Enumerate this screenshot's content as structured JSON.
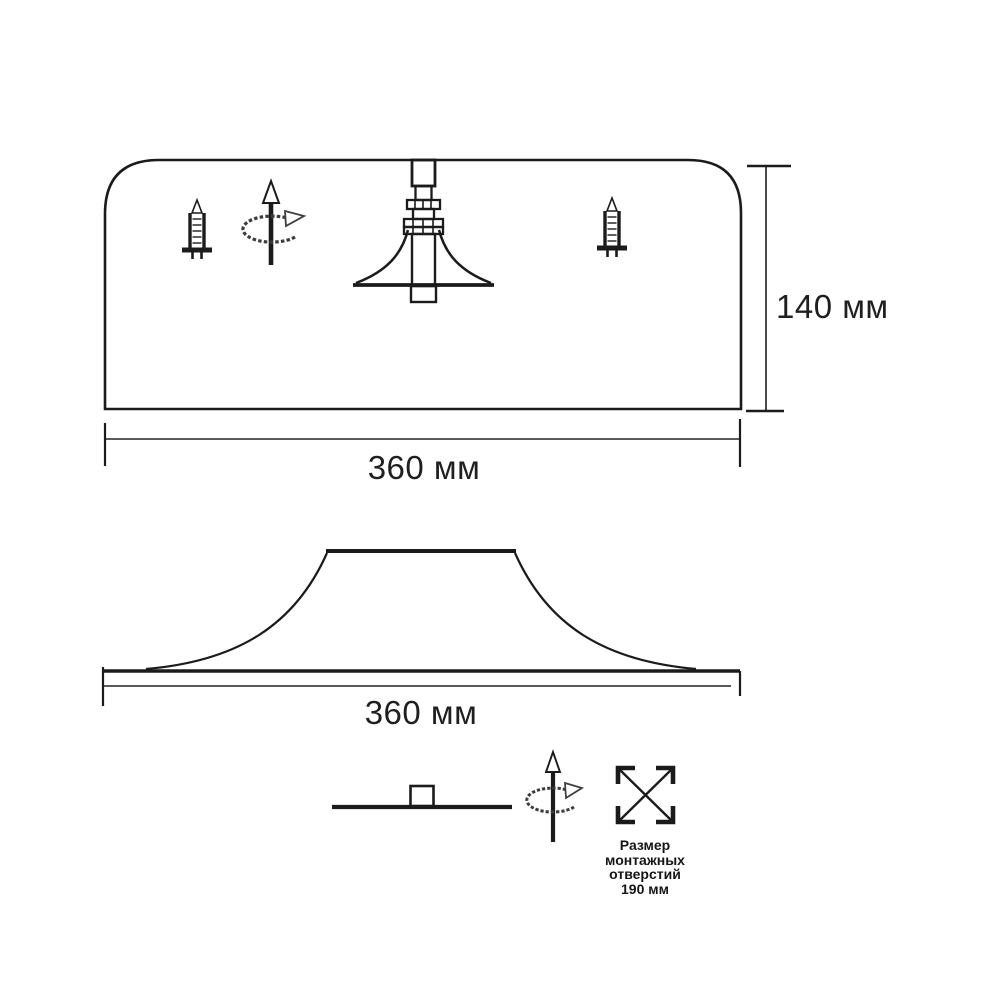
{
  "drawing": {
    "colors": {
      "line": "#1b1b1b",
      "dim_line": "#5a5a5a",
      "background": "#ffffff"
    },
    "top_view": {
      "height_dim_label": "140 мм",
      "width_dim_label": "360 мм"
    },
    "profile_view": {
      "width_dim_label": "360 мм"
    },
    "legend": {
      "mounting_holes_caption": [
        "Размер",
        "монтажных",
        "отверстий",
        "190 мм"
      ]
    },
    "icons": {
      "screw_left": "screw-icon",
      "screw_right": "screw-icon",
      "rotation_top": "rotation-arrow-icon",
      "rotation_bottom": "rotation-arrow-icon",
      "mounting_holes": "mounting-holes-icon",
      "side_view": "flat-lamp-side-icon"
    }
  }
}
